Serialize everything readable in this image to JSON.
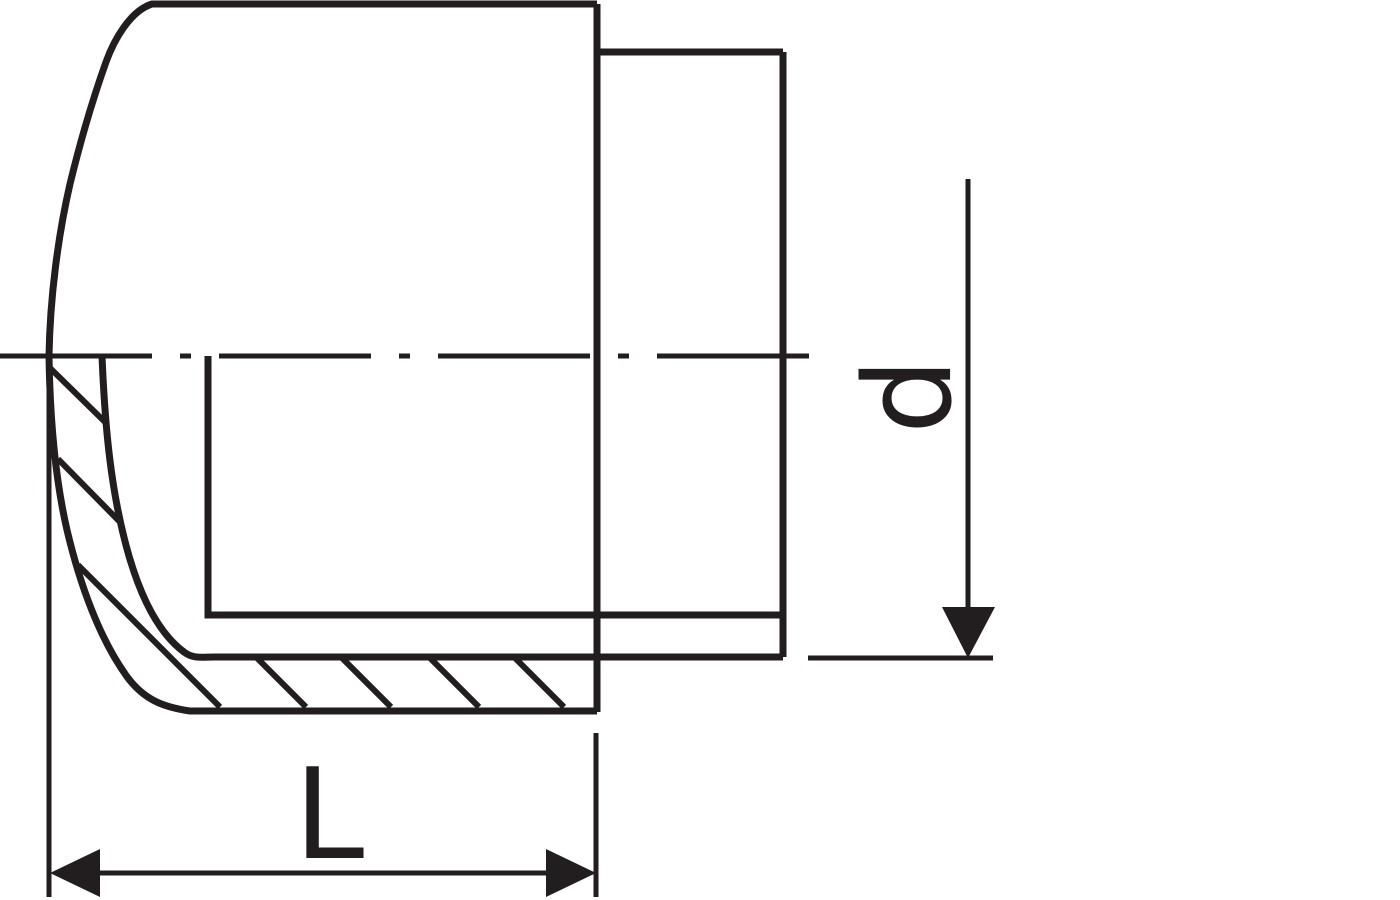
{
  "drawing": {
    "labels": {
      "diameter": "d",
      "length": "L"
    },
    "colors": {
      "line": "#221e1f",
      "background": "#ffffff"
    }
  }
}
